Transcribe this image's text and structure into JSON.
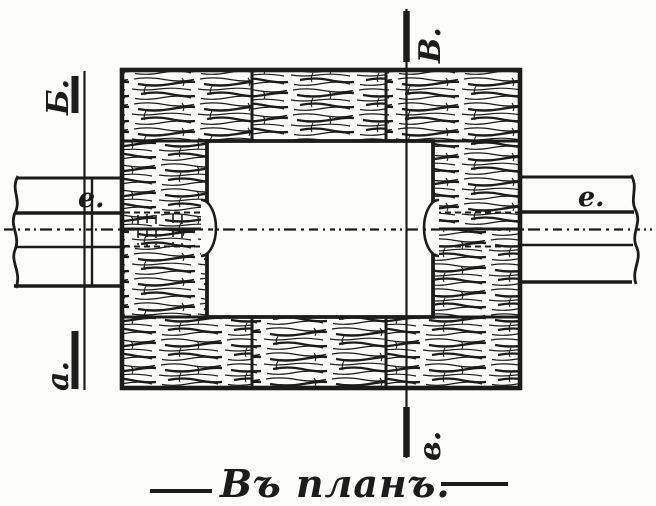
{
  "colors": {
    "paper": "#fdfdfb",
    "ink": "#1c1c1c"
  },
  "caption": {
    "text": "Въ планъ."
  },
  "section_lines": {
    "left": {
      "top_label": "Б.",
      "bottom_label": "а."
    },
    "right": {
      "top_label": "В.",
      "bottom_label": "в."
    }
  },
  "pipe_labels": {
    "left": "е.",
    "right": "е."
  }
}
